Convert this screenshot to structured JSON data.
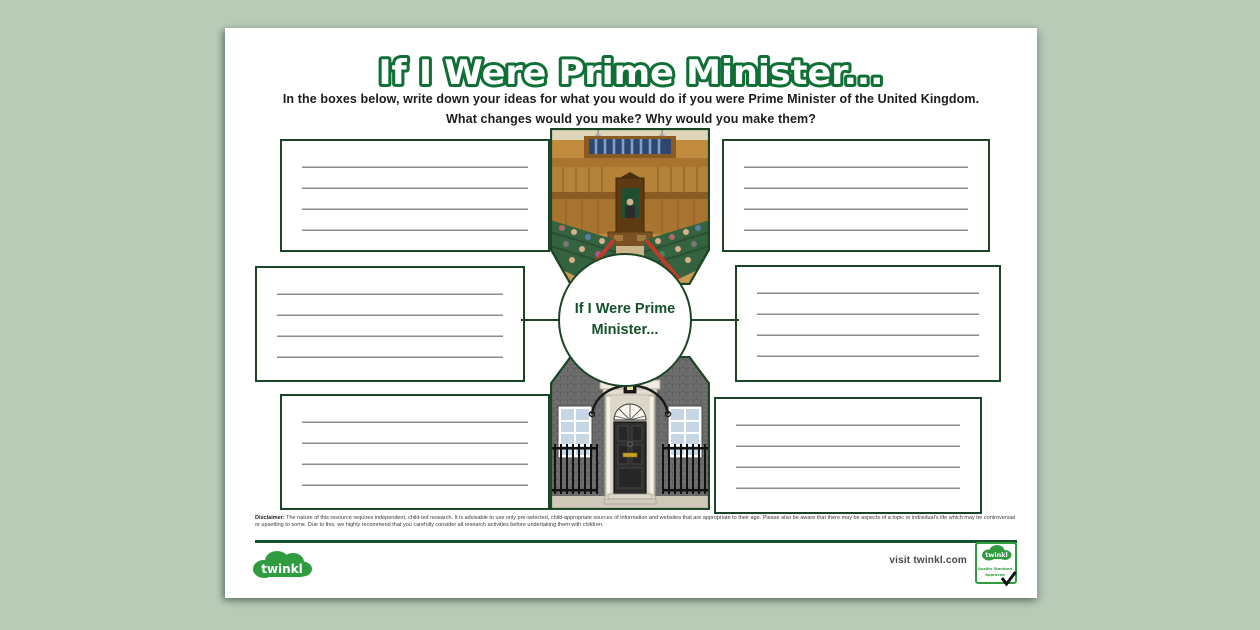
{
  "worksheet": {
    "title": "If I Were Prime Minister...",
    "instructions": [
      "In the boxes below, write down your ideas for what you would do if you were Prime Minister of the United Kingdom.",
      "What changes would you make? Why would you make them?"
    ],
    "center_circle": {
      "line1": "If I Were Prime",
      "line2": "Minister..."
    },
    "writing_boxes": {
      "count": 6,
      "lines_per_box": 4,
      "positions": [
        "top-left",
        "top-right",
        "middle-left",
        "middle-right",
        "bottom-left",
        "bottom-right"
      ]
    },
    "illustrations": [
      {
        "name": "house-of-commons-illustration"
      },
      {
        "name": "downing-street-door-illustration"
      }
    ]
  },
  "footer": {
    "disclaimer_label": "Disclaimer:",
    "disclaimer_body": " The nature of this resource requires independent, child-led research. It is advisable to use only pre-selected, child-appropriate sources of information and websites that are appropriate to their age. Please also be aware that there may be aspects of a topic or individual's life which may be controversial or upsetting to some. Due to this, we highly recommend that you carefully consider all research activities before undertaking them with children.",
    "visit_link": "visit twinkl.com",
    "brand": "twinkl",
    "badge": {
      "brand": "twinkl",
      "label_line1": "Quality Standard",
      "label_line2": "Approved"
    }
  },
  "colors": {
    "background": "#b7cbb7",
    "page": "#ffffff",
    "title_outline": "#0f6f35",
    "box_border": "#1c4527",
    "writing_line": "#8c8c8c",
    "center_text": "#14522a",
    "brand_green": "#2f9c3f"
  }
}
